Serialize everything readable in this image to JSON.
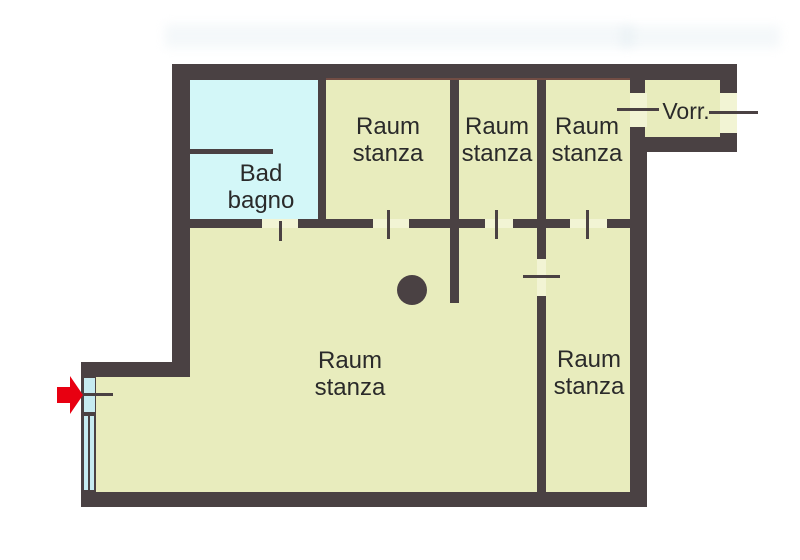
{
  "colors": {
    "wall": "#4a4143",
    "room": "#e8ecbd",
    "bath": "#d3f7f8",
    "opening": "#f2f4d4",
    "window": "#c6ebf1",
    "arrow": "#e80011",
    "text": "#2a2a2a"
  },
  "rooms": {
    "bathroom": {
      "line1": "Bad",
      "line2": "bagno"
    },
    "top1": {
      "line1": "Raum",
      "line2": "stanza"
    },
    "top2": {
      "line1": "Raum",
      "line2": "stanza"
    },
    "top3": {
      "line1": "Raum",
      "line2": "stanza"
    },
    "vorraum": {
      "label": "Vorr."
    },
    "main": {
      "line1": "Raum",
      "line2": "stanza"
    },
    "bottom_right": {
      "line1": "Raum",
      "line2": "stanza"
    }
  },
  "markers": {
    "entrance_arrow": {
      "icon": "arrow-right-icon",
      "color_key": "arrow"
    }
  }
}
